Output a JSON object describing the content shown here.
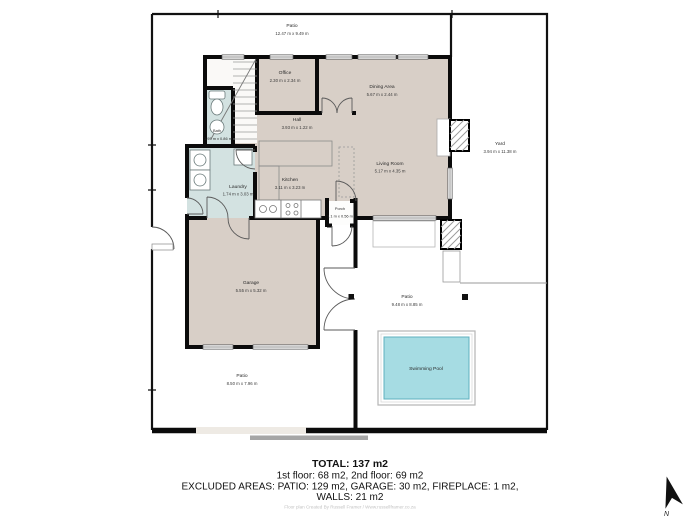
{
  "title": "Floor plan",
  "rooms": [
    {
      "id": "patio-top",
      "name": "Patio",
      "dims": "12.47 m x 9.49 m"
    },
    {
      "id": "office",
      "name": "Office",
      "dims": "2.30 m x 2.34 m"
    },
    {
      "id": "dining",
      "name": "Dining Area",
      "dims": "5.67 m x 2.44 m"
    },
    {
      "id": "hall",
      "name": "Hall",
      "dims": "3.93 m x 1.22 m"
    },
    {
      "id": "bath",
      "name": "Bath",
      "dims": "1.95 m x 0.86 m"
    },
    {
      "id": "yard",
      "name": "Yard",
      "dims": "3.94 m x 11.38 m"
    },
    {
      "id": "laundry",
      "name": "Laundry",
      "dims": "1.74 m x 3.03 m"
    },
    {
      "id": "kitchen",
      "name": "Kitchen",
      "dims": "3.11 m x 3.23 m"
    },
    {
      "id": "living",
      "name": "Living Room",
      "dims": "5.17 m x 4.35 m"
    },
    {
      "id": "porch",
      "name": "Porch",
      "dims": "1.1 m x 0.56 m"
    },
    {
      "id": "garage",
      "name": "Garage",
      "dims": "5.55 m x 5.32 m"
    },
    {
      "id": "patio-bottom",
      "name": "Patio",
      "dims": "8.50 m x 7.96 m"
    },
    {
      "id": "patio-pool",
      "name": "Patio",
      "dims": "9.48 m x 8.85 m"
    },
    {
      "id": "pool",
      "name": "Swimming Pool",
      "dims": ""
    }
  ],
  "summary": {
    "total": "TOTAL: 137 m2",
    "floors": "1st floor: 68 m2, 2nd floor: 69 m2",
    "excluded": "EXCLUDED AREAS: PATIO: 129 m2, GARAGE: 30 m2, FIREPLACE: 1 m2,",
    "walls": "WALLS: 21 m2"
  },
  "credit": "Floor plan Created By Russell Framer / Www.russellframer.co.za",
  "compass": {
    "label": "N"
  },
  "colors": {
    "floor": "#d8cfc7",
    "wet_room": "#d3e2e1",
    "pool_water": "#a6dce3",
    "wall": "#0b0b0b",
    "window": "#ececec",
    "outside": "#ffffff"
  }
}
